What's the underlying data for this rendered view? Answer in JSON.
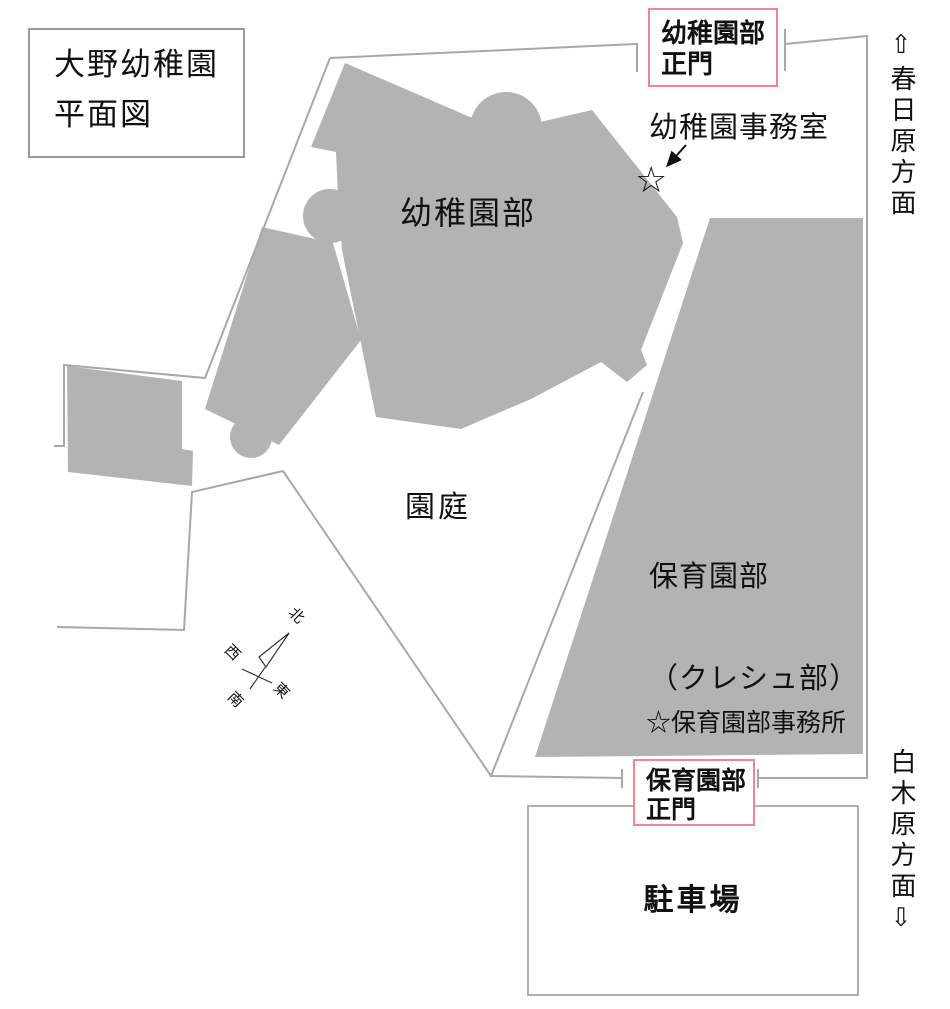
{
  "title_box": {
    "line1": "大野幼稚園",
    "line2": "平面図"
  },
  "gates": {
    "top": {
      "line1": "幼稚園部",
      "line2": "正門"
    },
    "bottom": {
      "line1": "保育園部",
      "line2": "正門"
    }
  },
  "buildings": {
    "kindergarten_label": "幼稚園部",
    "nursery_label_line1": "保育園部",
    "nursery_label_line2": "（クレシュ部）"
  },
  "labels": {
    "kindergarten_office": "幼稚園事務室",
    "kindergarten_office_star": "☆",
    "nursery_office": "☆保育園部事務所",
    "garden": "園庭",
    "parking": "駐車場"
  },
  "direction_signs": {
    "north": "⇧春日原方面",
    "south": "白木原方面⇩"
  },
  "compass": {
    "north": "北",
    "west": "西",
    "east": "東",
    "south": "南"
  },
  "colors": {
    "building_gray": "#b3b3b3",
    "boundary_gray": "#a8a8a8",
    "gate_red": "#f7838a",
    "text_black": "#111111"
  }
}
